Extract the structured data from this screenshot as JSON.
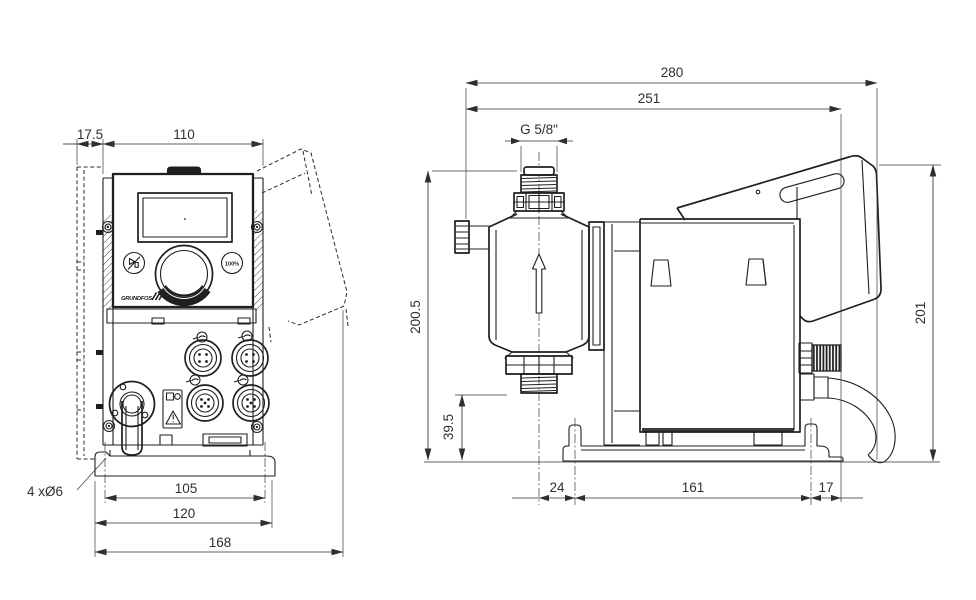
{
  "title": "Dosing pump dimensional drawing, front and side views",
  "colors": {
    "line": "#1f1f1f",
    "dimension": "#2f2f2f",
    "background": "#ffffff"
  },
  "front_view": {
    "dims": {
      "bracket_offset": "17.5",
      "housing_width": "110",
      "hole_spacing": "105",
      "baseplate_width": "120",
      "overall_width": "168"
    },
    "mounting_holes_note": "4 xØ6",
    "panel": {
      "button_100": "100%",
      "logo": "GRUNDFOS"
    }
  },
  "side_view": {
    "dims": {
      "overall_depth": "280",
      "depth_to_mount": "251",
      "connection_thread": "G 5/8\"",
      "overall_height": "200.5",
      "valve_height": "39.5",
      "module_height": "201",
      "head_overhang": "24",
      "baseplate_length": "161",
      "rear_overhang": "17"
    }
  }
}
